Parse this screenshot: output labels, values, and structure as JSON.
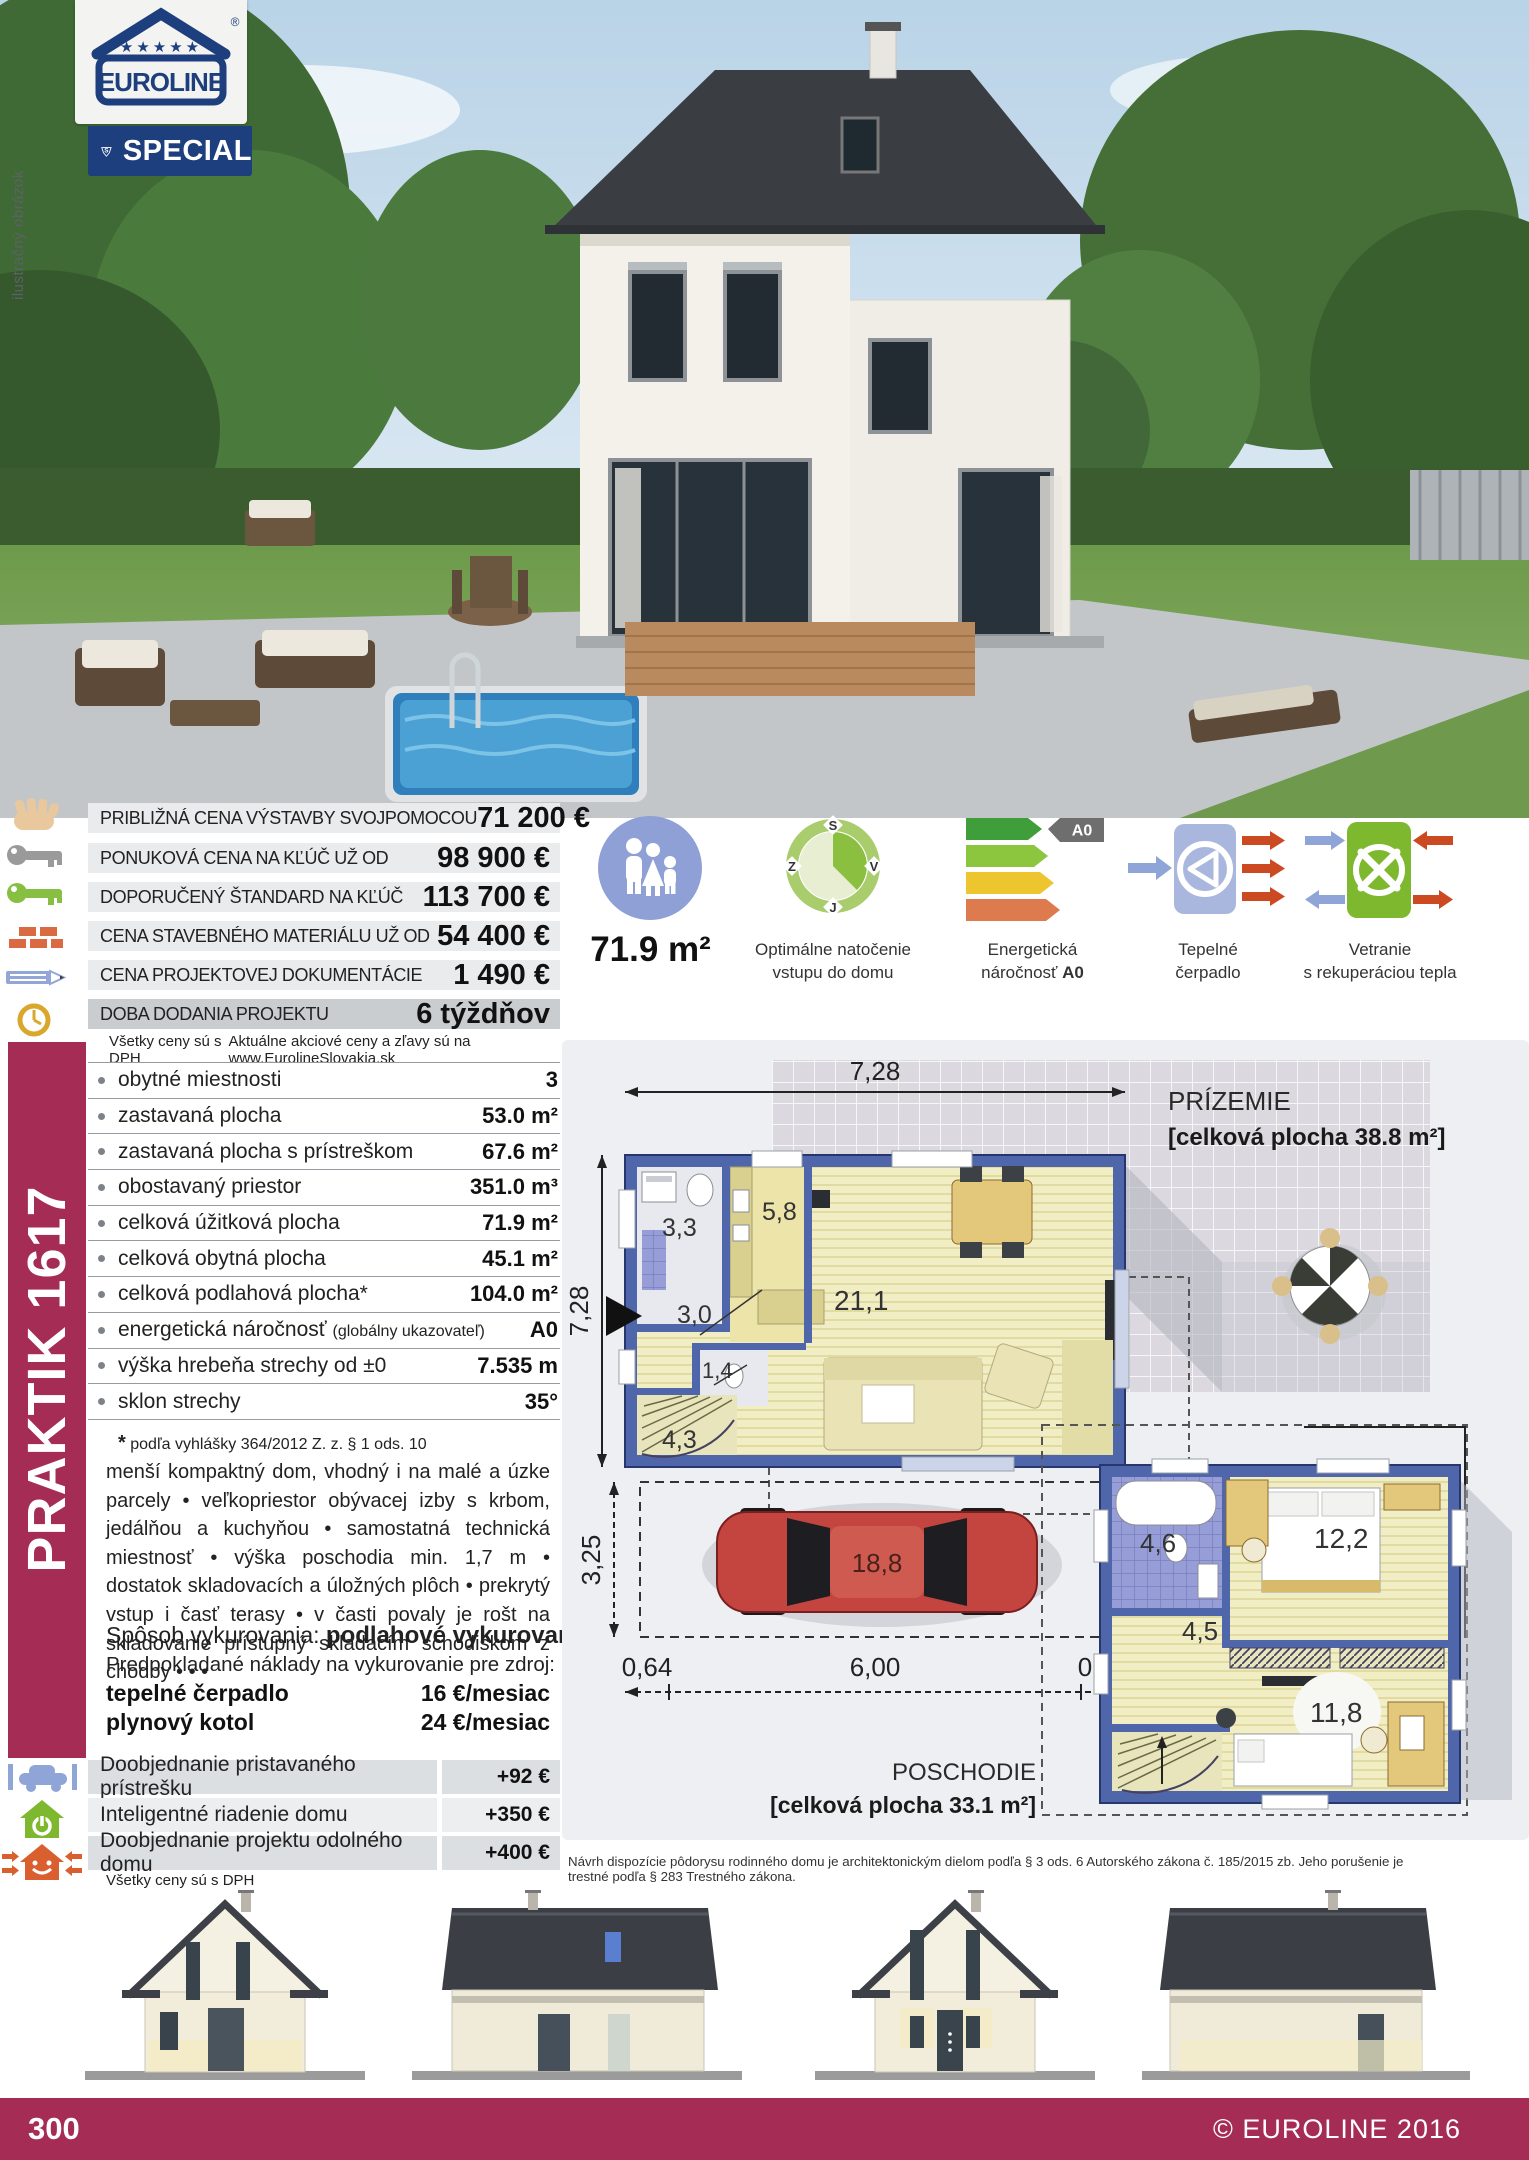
{
  "page": {
    "number": "300",
    "copyright": "© EUROLINE 2016"
  },
  "logo": {
    "brand": "EUROLINE",
    "registered": "®",
    "stars": "★★★★★",
    "badge_letter": "S",
    "badge_label": "SPECIAL"
  },
  "photo": {
    "watermark": "ilustračný obrázok"
  },
  "price_table": {
    "rows": [
      {
        "icon": "hand-icon",
        "label": "PRIBLIŽNÁ CENA VÝSTAVBY SVOJPOMOCOU",
        "value": "71 200 €"
      },
      {
        "icon": "key-gray-icon",
        "label": "PONUKOVÁ CENA NA KĽÚČ UŽ OD",
        "value": "98 900 €"
      },
      {
        "icon": "key-green-icon",
        "label": "DOPORUČENÝ ŠTANDARD NA KĽÚČ",
        "value": "113 700 €"
      },
      {
        "icon": "bricks-icon",
        "label": "CENA STAVEBNÉHO MATERIÁLU UŽ OD",
        "value": "54 400 €"
      },
      {
        "icon": "pencil-icon",
        "label": "CENA PROJEKTOVEJ DOKUMENTÁCIE",
        "value": "1 490 €"
      },
      {
        "icon": "clock-icon",
        "label": "DOBA DODANIA PROJEKTU",
        "value": "6 týždňov"
      }
    ],
    "note_left": "Všetky ceny sú s DPH",
    "note_right": "Aktuálne akciové ceny a zľavy sú na www.EurolineSlovakia.sk"
  },
  "highlights": {
    "usable_area": "71.9 m²",
    "orientation": {
      "label_line1": "Optimálne natočenie",
      "label_line2": "vstupu do domu",
      "compass": {
        "n": "S",
        "e": "V",
        "s": "J",
        "w": "Z"
      }
    },
    "energy": {
      "label_line1": "Energetická",
      "label_line2": "náročnosť ",
      "value": "A0"
    },
    "heat_pump": {
      "label_line1": "Tepelné",
      "label_line2": "čerpadlo"
    },
    "ventilation": {
      "label_line1": "Vetranie",
      "label_line2": "s rekuperáciou tepla"
    }
  },
  "model": {
    "name": "PRAKTIK 1617"
  },
  "specs": {
    "rows": [
      {
        "label": "obytné miestnosti",
        "value": "3"
      },
      {
        "label": "zastavaná plocha",
        "value": "53.0 m²"
      },
      {
        "label": "zastavaná plocha s prístreškom",
        "value": "67.6 m²"
      },
      {
        "label": "obostavaný priestor",
        "value": "351.0 m³"
      },
      {
        "label": "celková úžitková plocha",
        "value": "71.9 m²"
      },
      {
        "label": "celková obytná plocha",
        "value": "45.1 m²"
      },
      {
        "label": "celková podlahová plocha*",
        "value": "104.0 m²"
      },
      {
        "label": "energetická náročnosť ",
        "label_small": "(globálny ukazovateľ)",
        "value": "A0"
      },
      {
        "label": "výška hrebeňa strechy od ±0",
        "value": "7.535 m"
      },
      {
        "label": "sklon strechy",
        "value": "35°"
      }
    ],
    "footnote_star": "*",
    "footnote": " podľa vyhlášky 364/2012 Z. z. § 1 ods. 10"
  },
  "description": "menší kompaktný dom, vhodný i na malé a úzke parcely • veľkopriestor obývacej izby s krbom, jedálňou a kuchyňou • samostatná technická miestnosť • výška poschodia min. 1,7 m • dostatok skladovacích a úložných plôch • prekrytý vstup i časť terasy • v časti povaly je rošt na skladovanie prístupný skladacím schodiskom z chodby • • •",
  "heating": {
    "method_label": "Spôsob vykurovania: ",
    "method_value": "podlahové vykurovanie",
    "costs_intro": "Predpokladané náklady na vykurovanie pre zdroj:",
    "sources": [
      {
        "name": "tepelné čerpadlo",
        "cost": "16 €/mesiac"
      },
      {
        "name": "plynový kotol",
        "cost": "24 €/mesiac"
      }
    ]
  },
  "options": {
    "rows": [
      {
        "icon": "carport-icon",
        "label": "Doobjednanie pristavaného prístrešku",
        "value": "+92 €"
      },
      {
        "icon": "smart-home-icon",
        "label": "Inteligentné riadenie domu",
        "value": "+350 €"
      },
      {
        "icon": "resilient-house-icon",
        "label": "Doobjednanie projektu odolného domu",
        "value": "+400 €"
      }
    ],
    "note": "Všetky ceny sú s DPH"
  },
  "floorplans": {
    "ground": {
      "title": "PRÍZEMIE",
      "subtitle": "[celková plocha 38.8 m²]",
      "dim_top": "7,28",
      "dim_left": "7,28",
      "dim_carport": "3,25",
      "dims_bottom": [
        "0,64",
        "6,00",
        "0,64"
      ],
      "rooms": {
        "bathroom": "3,3",
        "kitchen": "5,8",
        "hall": "3,0",
        "living": "21,1",
        "wc": "1,4",
        "stairs": "4,3",
        "carport": "18,8"
      }
    },
    "upper": {
      "title": "POSCHODIE",
      "subtitle": "[celková plocha 33.1 m²]",
      "rooms": {
        "bathroom": "4,6",
        "bedroom": "12,2",
        "hall": "4,5",
        "room": "11,8"
      }
    },
    "legal": "Návrh dispozície pôdorysu rodinného domu je architektonickým dielom podľa § 3 ods. 6 Autorského zákona č. 185/2015 zb. Jeho porušenie je trestné podľa § 283 Trestného zákona."
  },
  "colors": {
    "crimson": "#a52c55",
    "navy": "#1e3f7d",
    "plan_wall_blue": "#4f66aa",
    "energy_value": "A0"
  }
}
